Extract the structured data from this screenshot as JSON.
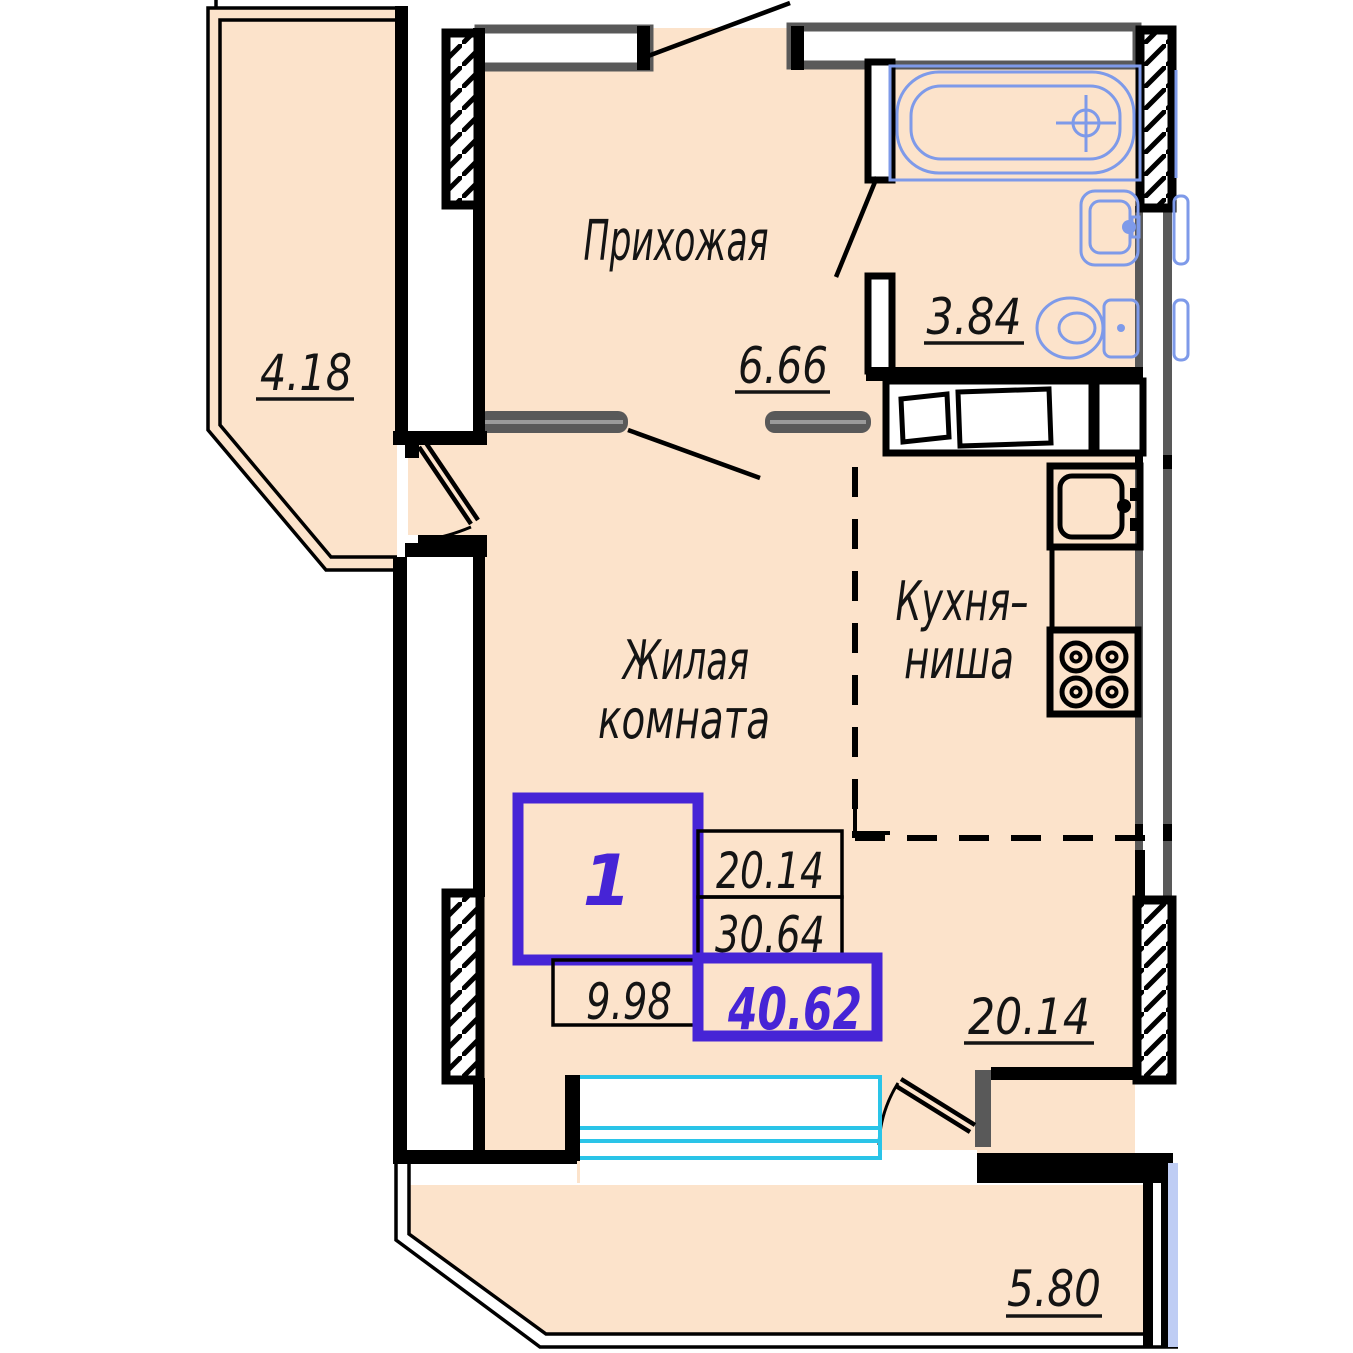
{
  "colors": {
    "floor": "#fce3cb",
    "wall_gray": "#595959",
    "fixture": "#7e9ae9",
    "window": "#2ac4e8",
    "glazing": "#bfcdf4",
    "stamp": "#4624d6"
  },
  "labels": {
    "hallway": {
      "name": "Прихожая",
      "area": "6.66"
    },
    "bathroom": {
      "area": "3.84"
    },
    "balcony_left": {
      "area": "4.18"
    },
    "living": {
      "name_line1": "Жилая",
      "name_line2": "комната",
      "area": "20.14"
    },
    "kitchen": {
      "name_line1": "Кухня–",
      "name_line2": "ниша"
    },
    "balcony_bottom": {
      "area": "5.80"
    }
  },
  "stamp": {
    "room_count": "1",
    "value_top": "20.14",
    "value_middle": "30.64",
    "value_left": "9.98",
    "value_total": "40.62"
  }
}
